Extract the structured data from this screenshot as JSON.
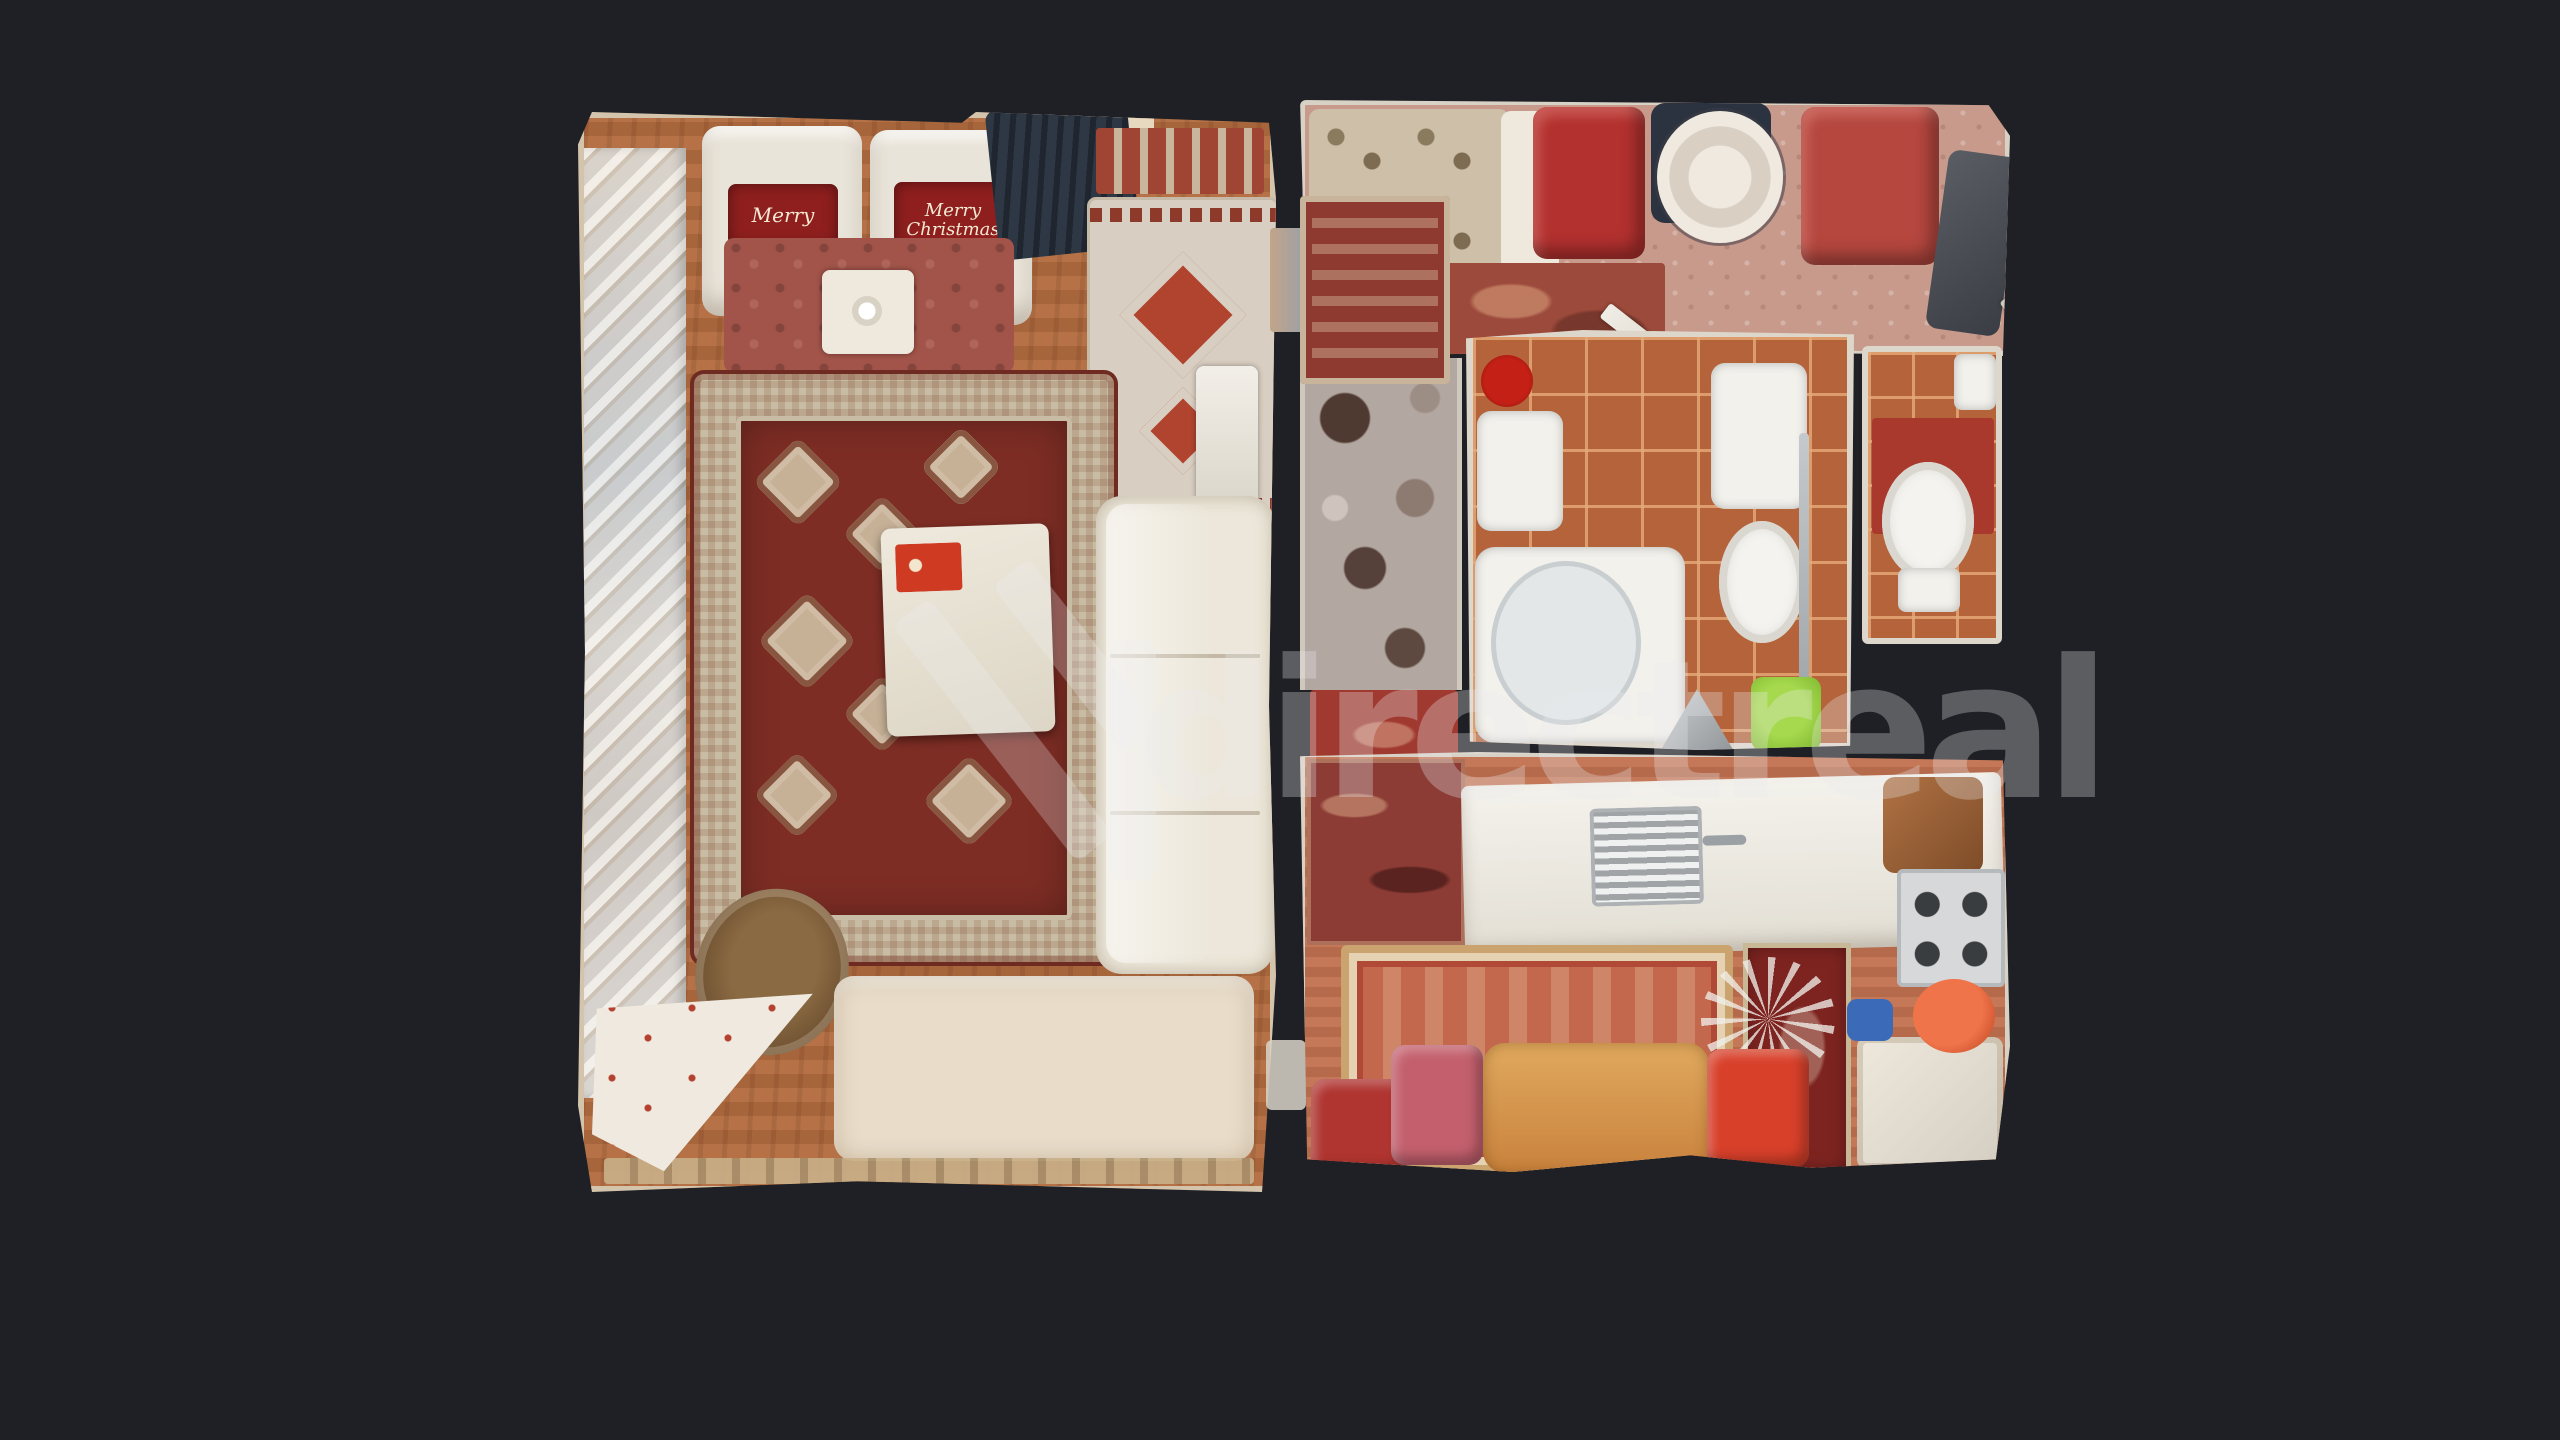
{
  "scene": {
    "kind": "3d-scan dollhouse top-down floor plan",
    "background_color": "#1e2025",
    "watermark": {
      "text": "directreal",
      "logo": "directreal-chevron-logo",
      "color": "rgba(235,235,240,0.30)"
    },
    "pillows": {
      "left_text": "Merry",
      "right_line1": "Merry",
      "right_line2": "Christmas"
    },
    "rooms": [
      {
        "name": "living-room",
        "floor": "#b06a3e",
        "features": [
          "two white armchairs with red Merry Christmas pillows",
          "red shag rug",
          "aztec kilim rug",
          "large persian rug",
          "white gift box with red label",
          "white sofa",
          "cream bed",
          "wicker chair",
          "white dotted cloth",
          "mirrored wardrobe strip"
        ]
      },
      {
        "name": "entry-hall",
        "floor": "#c79a8c",
        "features": [
          "patterned bench",
          "red stool",
          "round side table",
          "red armchair",
          "dark coat rack",
          "ornate runner rug",
          "swirl rug",
          "open door leaves"
        ]
      },
      {
        "name": "corridor",
        "floor": "#b3a7a2",
        "features": [
          "flower-patterned carpet",
          "red rug"
        ]
      },
      {
        "name": "bathroom",
        "floor": "#b4633a",
        "features": [
          "bathtub",
          "washbasin",
          "red vase",
          "toilet with cistern",
          "green bucket",
          "floor drain"
        ]
      },
      {
        "name": "wc",
        "floor": "#b4663c",
        "features": [
          "toilet",
          "red mat",
          "corner basin"
        ]
      },
      {
        "name": "kitchen",
        "floor": "#bf7050",
        "features": [
          "wall tapestry",
          "white counter with sink",
          "gas stove",
          "bordered rug",
          "wooden dining table",
          "red chair",
          "pink chair",
          "orange chair",
          "white cabinet",
          "dried plant",
          "red wall picture",
          "wooden chair",
          "orange pot",
          "blue jug"
        ]
      }
    ],
    "palette": {
      "wall": "#ddd6ca",
      "tile_grout": "#e6aa78",
      "persian_rug_field": "#7d2d24",
      "persian_rug_border": "#c9bca4",
      "accent_red": "#b3312f",
      "accent_green": "#8cc63e"
    }
  }
}
